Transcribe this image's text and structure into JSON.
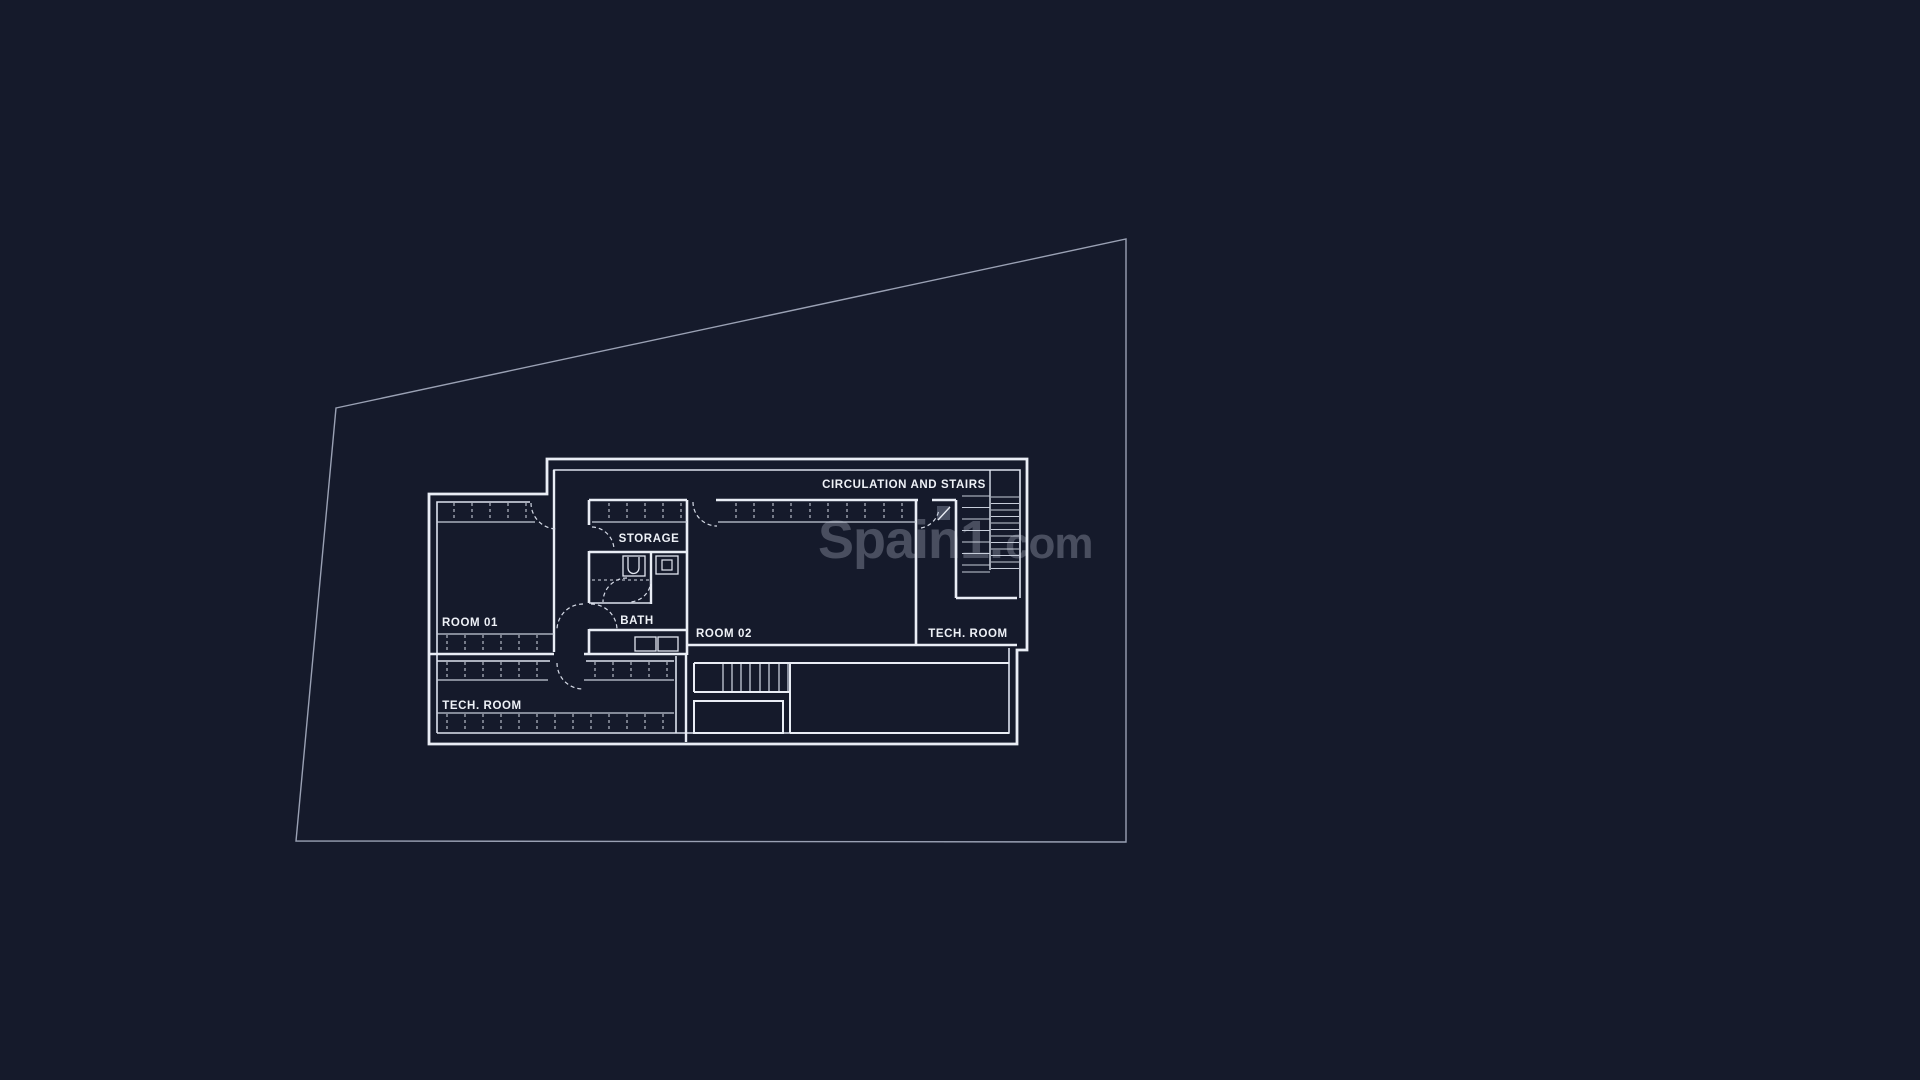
{
  "canvas": {
    "width": 1920,
    "height": 1080,
    "background": "#151a2b"
  },
  "colors": {
    "wall_line": "#e9edf5",
    "dashed_line": "#d5dae6",
    "site_boundary": "#9aa1b4",
    "label_text": "#eef1f7",
    "watermark": "rgba(214,220,235,0.27)"
  },
  "labels": {
    "circulation_and_stairs": "CIRCULATION AND STAIRS",
    "storage": "STORAGE",
    "room_01": "ROOM 01",
    "bath": "BATH",
    "room_02": "ROOM 02",
    "tech_room_right": "TECH. ROOM",
    "tech_room_left": "TECH. ROOM"
  },
  "watermark": {
    "primary": "Spain1.",
    "secondary": "com"
  }
}
